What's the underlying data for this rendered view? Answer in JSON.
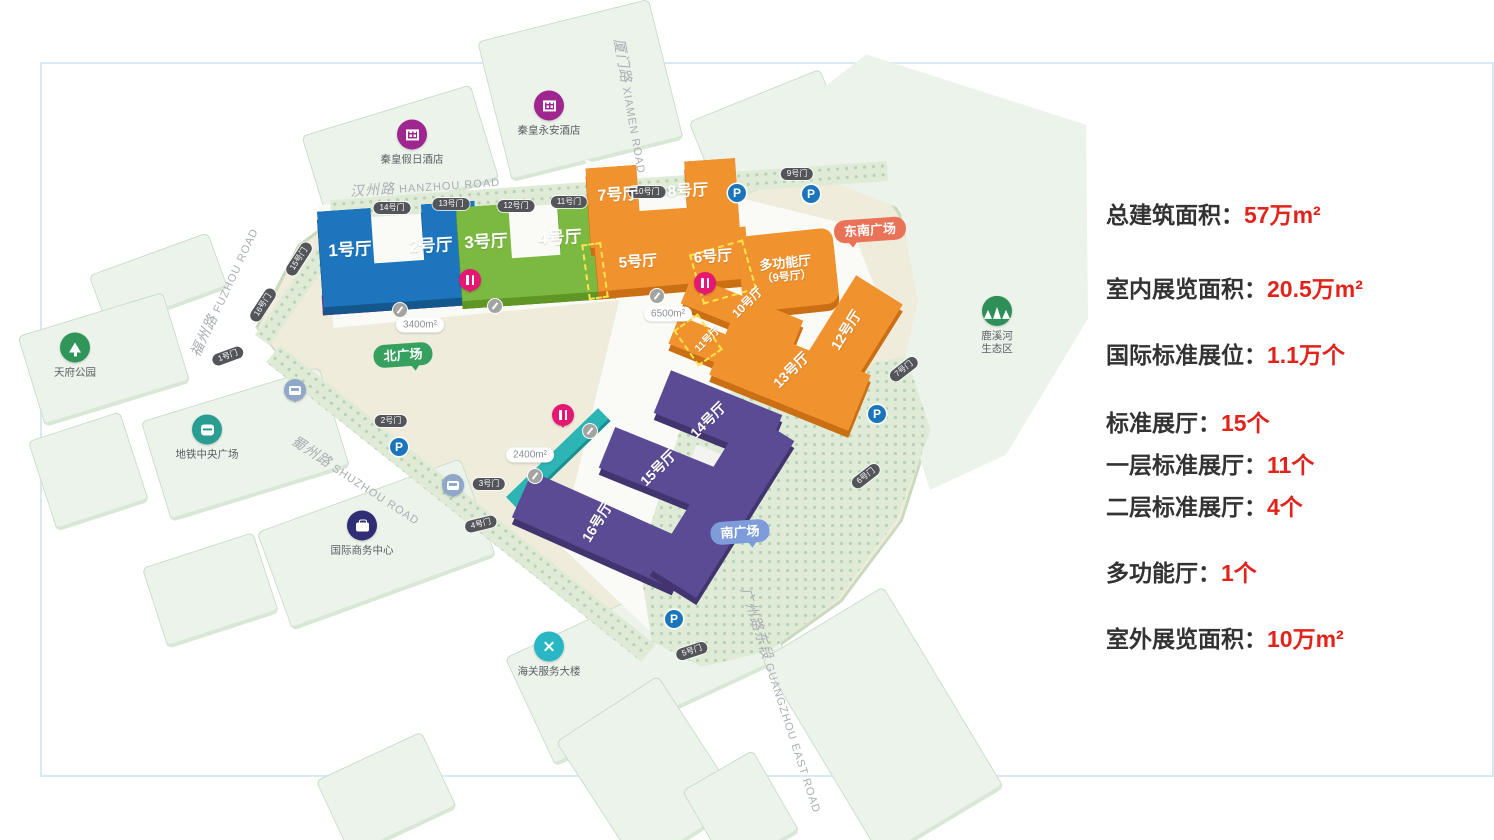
{
  "stats": [
    {
      "label": "总建筑面积：",
      "value": "57万m²"
    },
    {
      "label": "室内展览面积：",
      "value": "20.5万m²"
    },
    {
      "label": "国际标准展位：",
      "value": "1.1万个"
    },
    {
      "label": "标准展厅：",
      "value": "15个"
    },
    {
      "label": "一层标准展厅：",
      "value": "11个"
    },
    {
      "label": "二层标准展厅：",
      "value": "4个"
    },
    {
      "label": "多功能厅：",
      "value": "1个"
    },
    {
      "label": "室外展览面积：",
      "value": "10万m²"
    }
  ],
  "colors": {
    "accentRed": "#e2231a",
    "hallBlue": "#1d76bd",
    "hallGreen": "#7cb940",
    "hallOrange": "#f0922e",
    "hallPurple": "#5b4b94",
    "stripMagenta": "#a81d78",
    "stripTeal": "#2cb5b4",
    "parking": "#1b75bb"
  },
  "map": {
    "roads": [
      {
        "zh": "汉州路",
        "en": "HANZHOU ROAD",
        "x": 425,
        "y": 186,
        "rot": -4
      },
      {
        "zh": "福州路",
        "en": "FUZHOU ROAD",
        "x": 224,
        "y": 292,
        "rot": -65
      },
      {
        "zh": "蜀州路",
        "en": "SHUZHOU ROAD",
        "x": 356,
        "y": 480,
        "rot": 33
      },
      {
        "zh": "厦门路",
        "en": "XIAMEN ROAD",
        "x": 631,
        "y": 106,
        "rot": 80
      },
      {
        "zh": "广州路东段",
        "en": "GUANGZHOU EAST ROAD",
        "x": 782,
        "y": 700,
        "rot": 72
      }
    ],
    "gates": [
      {
        "t": "1号门",
        "x": 228,
        "y": 356,
        "r": -20
      },
      {
        "t": "2号门",
        "x": 391,
        "y": 421,
        "r": 0
      },
      {
        "t": "3号门",
        "x": 489,
        "y": 484,
        "r": 0
      },
      {
        "t": "4号门",
        "x": 481,
        "y": 524,
        "r": -14
      },
      {
        "t": "5号门",
        "x": 692,
        "y": 651,
        "r": -18
      },
      {
        "t": "6号门",
        "x": 866,
        "y": 476,
        "r": -38
      },
      {
        "t": "7号门",
        "x": 904,
        "y": 369,
        "r": -38
      },
      {
        "t": "9号门",
        "x": 797,
        "y": 174,
        "r": 0
      },
      {
        "t": "10号门",
        "x": 647,
        "y": 192,
        "r": 0
      },
      {
        "t": "11号门",
        "x": 569,
        "y": 202,
        "r": 0
      },
      {
        "t": "12号门",
        "x": 516,
        "y": 206,
        "r": 0
      },
      {
        "t": "13号门",
        "x": 451,
        "y": 204,
        "r": 0
      },
      {
        "t": "14号门",
        "x": 392,
        "y": 208,
        "r": 0
      },
      {
        "t": "15号门",
        "x": 299,
        "y": 259,
        "r": -57
      },
      {
        "t": "16号门",
        "x": 263,
        "y": 305,
        "r": -57
      }
    ],
    "halls": [
      {
        "t": "1号厅",
        "x": 350,
        "y": 250,
        "r": -3,
        "s": 17
      },
      {
        "t": "2号厅",
        "x": 431,
        "y": 246,
        "r": -3,
        "s": 17
      },
      {
        "t": "3号厅",
        "x": 486,
        "y": 242,
        "r": -3,
        "s": 17
      },
      {
        "t": "4号厅",
        "x": 560,
        "y": 238,
        "r": -3,
        "s": 17
      },
      {
        "t": "5号厅",
        "x": 638,
        "y": 262,
        "r": -4,
        "s": 15
      },
      {
        "t": "6号厅",
        "x": 713,
        "y": 257,
        "r": -4,
        "s": 15
      },
      {
        "t": "7号厅",
        "x": 618,
        "y": 196,
        "r": -3,
        "s": 16
      },
      {
        "t": "8号厅",
        "x": 688,
        "y": 192,
        "r": -3,
        "s": 16
      },
      {
        "t": "多功能厅",
        "t2": "（9号厅）",
        "x": 786,
        "y": 270,
        "r": -6,
        "s": 13
      },
      {
        "t": "10号厅",
        "x": 748,
        "y": 303,
        "r": -45,
        "s": 12
      },
      {
        "t": "11号厅",
        "x": 708,
        "y": 340,
        "r": -45,
        "s": 10
      },
      {
        "t": "12号厅",
        "x": 846,
        "y": 330,
        "r": -58,
        "s": 14
      },
      {
        "t": "13号厅",
        "x": 791,
        "y": 370,
        "r": -45,
        "s": 14
      },
      {
        "t": "14号厅",
        "x": 708,
        "y": 420,
        "r": -45,
        "s": 14
      },
      {
        "t": "15号厅",
        "x": 658,
        "y": 468,
        "r": -45,
        "s": 14
      },
      {
        "t": "16号厅",
        "x": 597,
        "y": 522,
        "r": -58,
        "s": 14
      }
    ],
    "parking": [
      [
        737,
        193
      ],
      [
        811,
        194
      ],
      [
        399,
        447
      ],
      [
        877,
        414
      ],
      [
        674,
        619
      ]
    ],
    "area_pills": [
      {
        "t": "3400m²",
        "x": 420,
        "y": 325
      },
      {
        "t": "6500m²",
        "x": 668,
        "y": 314
      },
      {
        "t": "2400m²",
        "x": 530,
        "y": 455
      }
    ],
    "plazas": [
      {
        "t": "北广场",
        "x": 403,
        "y": 355,
        "c": "#36a05f",
        "tail": "tbr",
        "r": -4
      },
      {
        "t": "南广场",
        "x": 740,
        "y": 532,
        "c": "#7e9cda",
        "tail": "tbr",
        "r": -4
      },
      {
        "t": "东南广场",
        "x": 870,
        "y": 230,
        "c": "#e97257",
        "tail": "tbl",
        "r": -4
      }
    ],
    "pois": [
      {
        "t": "秦皇假日酒店",
        "x": 412,
        "y": 131,
        "c": "#a0268f",
        "icon": "building"
      },
      {
        "t": "秦皇永安酒店",
        "x": 549,
        "y": 102,
        "c": "#a0268f",
        "icon": "building"
      },
      {
        "t": "天府公园",
        "x": 75,
        "y": 344,
        "c": "#2f9558",
        "icon": "tree"
      },
      {
        "t": "地铁中央广场",
        "x": 207,
        "y": 426,
        "c": "#2a9d93",
        "icon": "metro"
      },
      {
        "t": "国际商务中心",
        "x": 362,
        "y": 522,
        "c": "#2f2d74",
        "icon": "briefcase"
      },
      {
        "t": "海关服务大楼",
        "x": 549,
        "y": 643,
        "c": "#29b7c5",
        "icon": "customs"
      },
      {
        "t": "鹿溪河",
        "t2": "生态区",
        "x": 997,
        "y": 314,
        "c": "#2e8f57",
        "icon": "trees"
      }
    ],
    "pins": {
      "food": [
        [
          470,
          280
        ],
        [
          705,
          283
        ],
        [
          563,
          415
        ]
      ],
      "bus": [
        [
          295,
          390
        ],
        [
          453,
          485
        ]
      ],
      "walk": [
        [
          400,
          310
        ],
        [
          495,
          306
        ],
        [
          657,
          296
        ],
        [
          590,
          431
        ],
        [
          535,
          476
        ]
      ]
    }
  }
}
